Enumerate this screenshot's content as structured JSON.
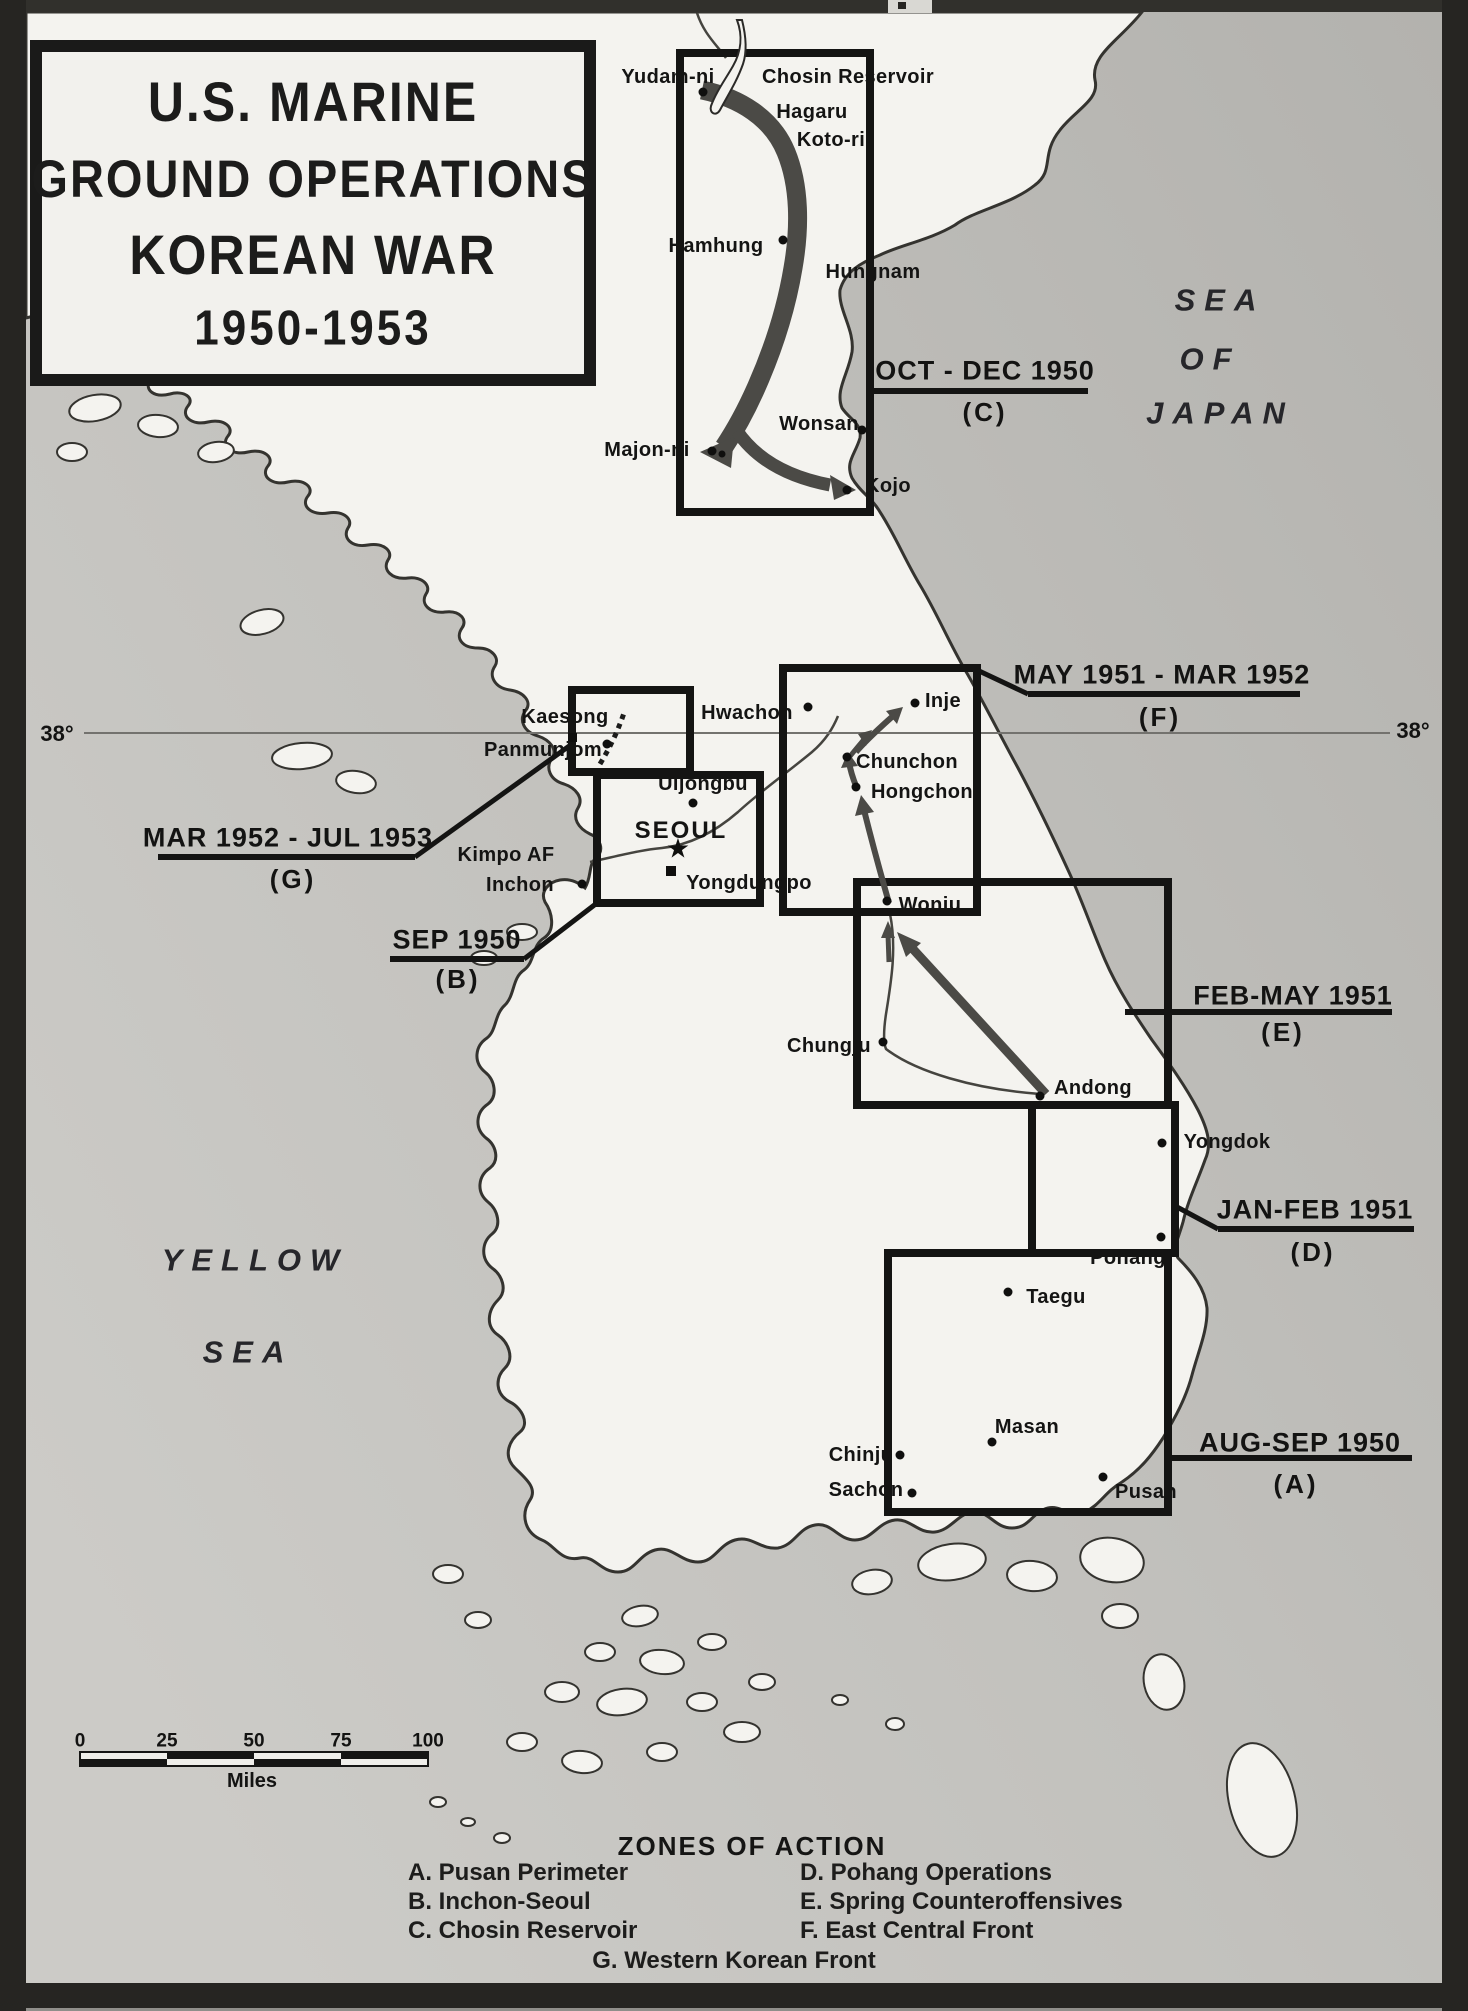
{
  "title": {
    "lines": [
      "U.S. MARINE",
      "GROUND OPERATIONS",
      "KOREAN WAR",
      "1950-1953"
    ]
  },
  "seas": {
    "sea_of_japan": {
      "lines": [
        "SEA",
        "OF",
        "JAPAN"
      ]
    },
    "yellow_sea": {
      "lines": [
        "YELLOW",
        "SEA"
      ]
    }
  },
  "parallel": {
    "left": "38°",
    "right": "38°"
  },
  "zones": [
    {
      "id": "A",
      "label": "AUG-SEP 1950",
      "letter": "(A)"
    },
    {
      "id": "B",
      "label": "SEP 1950",
      "letter": "(B)"
    },
    {
      "id": "C",
      "label": "OCT - DEC 1950",
      "letter": "(C)"
    },
    {
      "id": "D",
      "label": "JAN-FEB 1951",
      "letter": "(D)"
    },
    {
      "id": "E",
      "label": "FEB-MAY 1951",
      "letter": "(E)"
    },
    {
      "id": "F",
      "label": "MAY 1951 - MAR 1952",
      "letter": "(F)"
    },
    {
      "id": "G",
      "label": "MAR 1952 - JUL 1953",
      "letter": "(G)"
    }
  ],
  "cities": {
    "yudamni": "Yudam-ni",
    "chosin_reservoir": "Chosin Reservoir",
    "hagaru": "Hagaru",
    "kotori": "Koto-ri",
    "hamhung": "Hamhung",
    "hungnam": "Hungnam",
    "wonsan": "Wonsan",
    "majonni": "Majon-ni",
    "kojo": "Kojo",
    "kaesong": "Kaesong",
    "panmunjom": "Panmunjom",
    "hwachon": "Hwachon",
    "inje": "Inje",
    "chunchon": "Chunchon",
    "hongchon": "Hongchon",
    "uijongbu": "Uijongbu",
    "seoul": "SEOUL",
    "kimpo": "Kimpo AF",
    "inchon": "Inchon",
    "yongdungpo": "Yongdungpo",
    "wonju": "Wonju",
    "chungju": "Chungju",
    "andong": "Andong",
    "yongdok": "Yongdok",
    "pohang": "Pohang",
    "taegu": "Taegu",
    "masan": "Masan",
    "chinju": "Chinju",
    "sachon": "Sachon",
    "pusan": "Pusan"
  },
  "icons": {
    "seoul_star": "★"
  },
  "scale": {
    "ticks": [
      "0",
      "25",
      "50",
      "75",
      "100"
    ],
    "unit": "Miles"
  },
  "legend": {
    "heading": "ZONES OF ACTION",
    "items_left": [
      "A. Pusan Perimeter",
      "B. Inchon-Seoul",
      "C. Chosin Reservoir"
    ],
    "items_right": [
      "D. Pohang Operations",
      "E. Spring Counteroffensives",
      "F. East Central Front"
    ],
    "item_center": "G. Western Korean Front"
  },
  "colors": {
    "land": "#f4f3ef",
    "coast": "#34332f",
    "ink": "#141413",
    "arrow": "#4b4a46",
    "sea_dark": "#b5b4b0",
    "sea_light": "#cccbc7"
  }
}
